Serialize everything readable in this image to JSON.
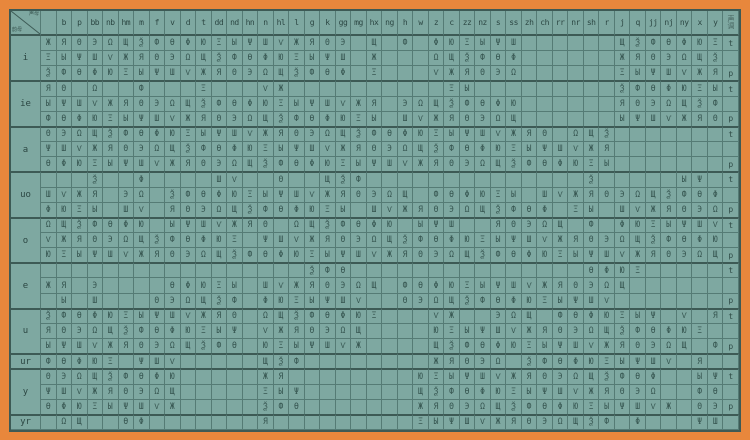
{
  "corner": {
    "top_right": "声母",
    "bottom_left": "韵母"
  },
  "tone_column_header": "声调",
  "columns": [
    "",
    "b",
    "p",
    "bb",
    "nb",
    "hm",
    "m",
    "f",
    "v",
    "d",
    "t",
    "dd",
    "nd",
    "hn",
    "n",
    "hl",
    "l",
    "g",
    "k",
    "gg",
    "mg",
    "hx",
    "ng",
    "h",
    "w",
    "z",
    "c",
    "zz",
    "nz",
    "s",
    "ss",
    "zh",
    "ch",
    "rr",
    "nr",
    "sh",
    "r",
    "j",
    "q",
    "jj",
    "nj",
    "ny",
    "x",
    "y"
  ],
  "sections": [
    {
      "vowel": "i",
      "rows": [
        {
          "tone": "t",
          "fill": "11111111111111111111010101111110000001111111"
        },
        {
          "tone": "",
          "fill": "11111111111111111111010001111110000001111111"
        },
        {
          "tone": "p",
          "fill": "11111111111111111111010001111110000001111111"
        }
      ]
    },
    {
      "vowel": "ie",
      "rows": [
        {
          "tone": "t",
          "fill": "11010010001000110000000000110000000001111111"
        },
        {
          "tone": "",
          "fill": "11111111111111111111110111111110000001111111"
        },
        {
          "tone": "p",
          "fill": "11111111111111111111110111111110000001111111"
        }
      ]
    },
    {
      "vowel": "a",
      "rows": [
        {
          "tone": "t",
          "fill": "11111111111111111111111111111111101110000000"
        },
        {
          "tone": "",
          "fill": "11111111111111111111111111111111111110000000"
        },
        {
          "tone": "p",
          "fill": "11111111111111111111111111111111111110000000"
        }
      ]
    },
    {
      "vowel": "uo",
      "rows": [
        {
          "tone": "t",
          "fill": "00010010000110010011100000000000000100000110"
        },
        {
          "tone": "",
          "fill": "11110110111111111111111101111110111111111111"
        },
        {
          "tone": "p",
          "fill": "11110110111111111111011111111111101101111111"
        }
      ]
    },
    {
      "vowel": "o",
      "rows": [
        {
          "tone": "t",
          "fill": "11111110111111101111111011100111110101111111"
        },
        {
          "tone": "",
          "fill": "11111111111110111111111111111111111111111111"
        },
        {
          "tone": "p",
          "fill": "11111111111111111111111111111111111111111111"
        }
      ]
    },
    {
      "vowel": "e",
      "rows": [
        {
          "tone": "t",
          "fill": "00000000000000000111000000000000000111100000"
        },
        {
          "tone": "",
          "fill": "11010000111110111111110111111111111111000000"
        },
        {
          "tone": "p",
          "fill": "01010001111110111111100111111111111110000000"
        }
      ]
    },
    {
      "vowel": "u",
      "rows": [
        {
          "tone": "t",
          "fill": "11111111111110111111110001100111011111110101"
        },
        {
          "tone": "",
          "fill": "11111111111110111111100001111111111111111110"
        },
        {
          "tone": "p",
          "fill": "11111111111110111111100001111111111111111101"
        }
      ]
    },
    {
      "vowel": "ur",
      "rows": [
        {
          "tone": "",
          "fill": "11111011100000111000000001111101111111111010"
        }
      ]
    },
    {
      "vowel": "y",
      "rows": [
        {
          "tone": "t",
          "fill": "11111111100000110000000011111111111111110011"
        },
        {
          "tone": "",
          "fill": "11111111100000111000000011111111111111110011"
        },
        {
          "tone": "p",
          "fill": "11111111100000111000000011111111111111111011"
        }
      ]
    },
    {
      "vowel": "yr",
      "rows": [
        {
          "tone": "",
          "fill": "01100110000000100000000011111111111110100011"
        }
      ]
    }
  ],
  "glyph_palette": "ЖФШЩЫЭЮЯѲѴѮΨΩΞΘΦ",
  "colors": {
    "frame": "#e8873c",
    "cell_bg": "#7ea8a1",
    "grid_line": "#557b75",
    "section_line": "#3d5a55",
    "ink": "#31504b"
  }
}
